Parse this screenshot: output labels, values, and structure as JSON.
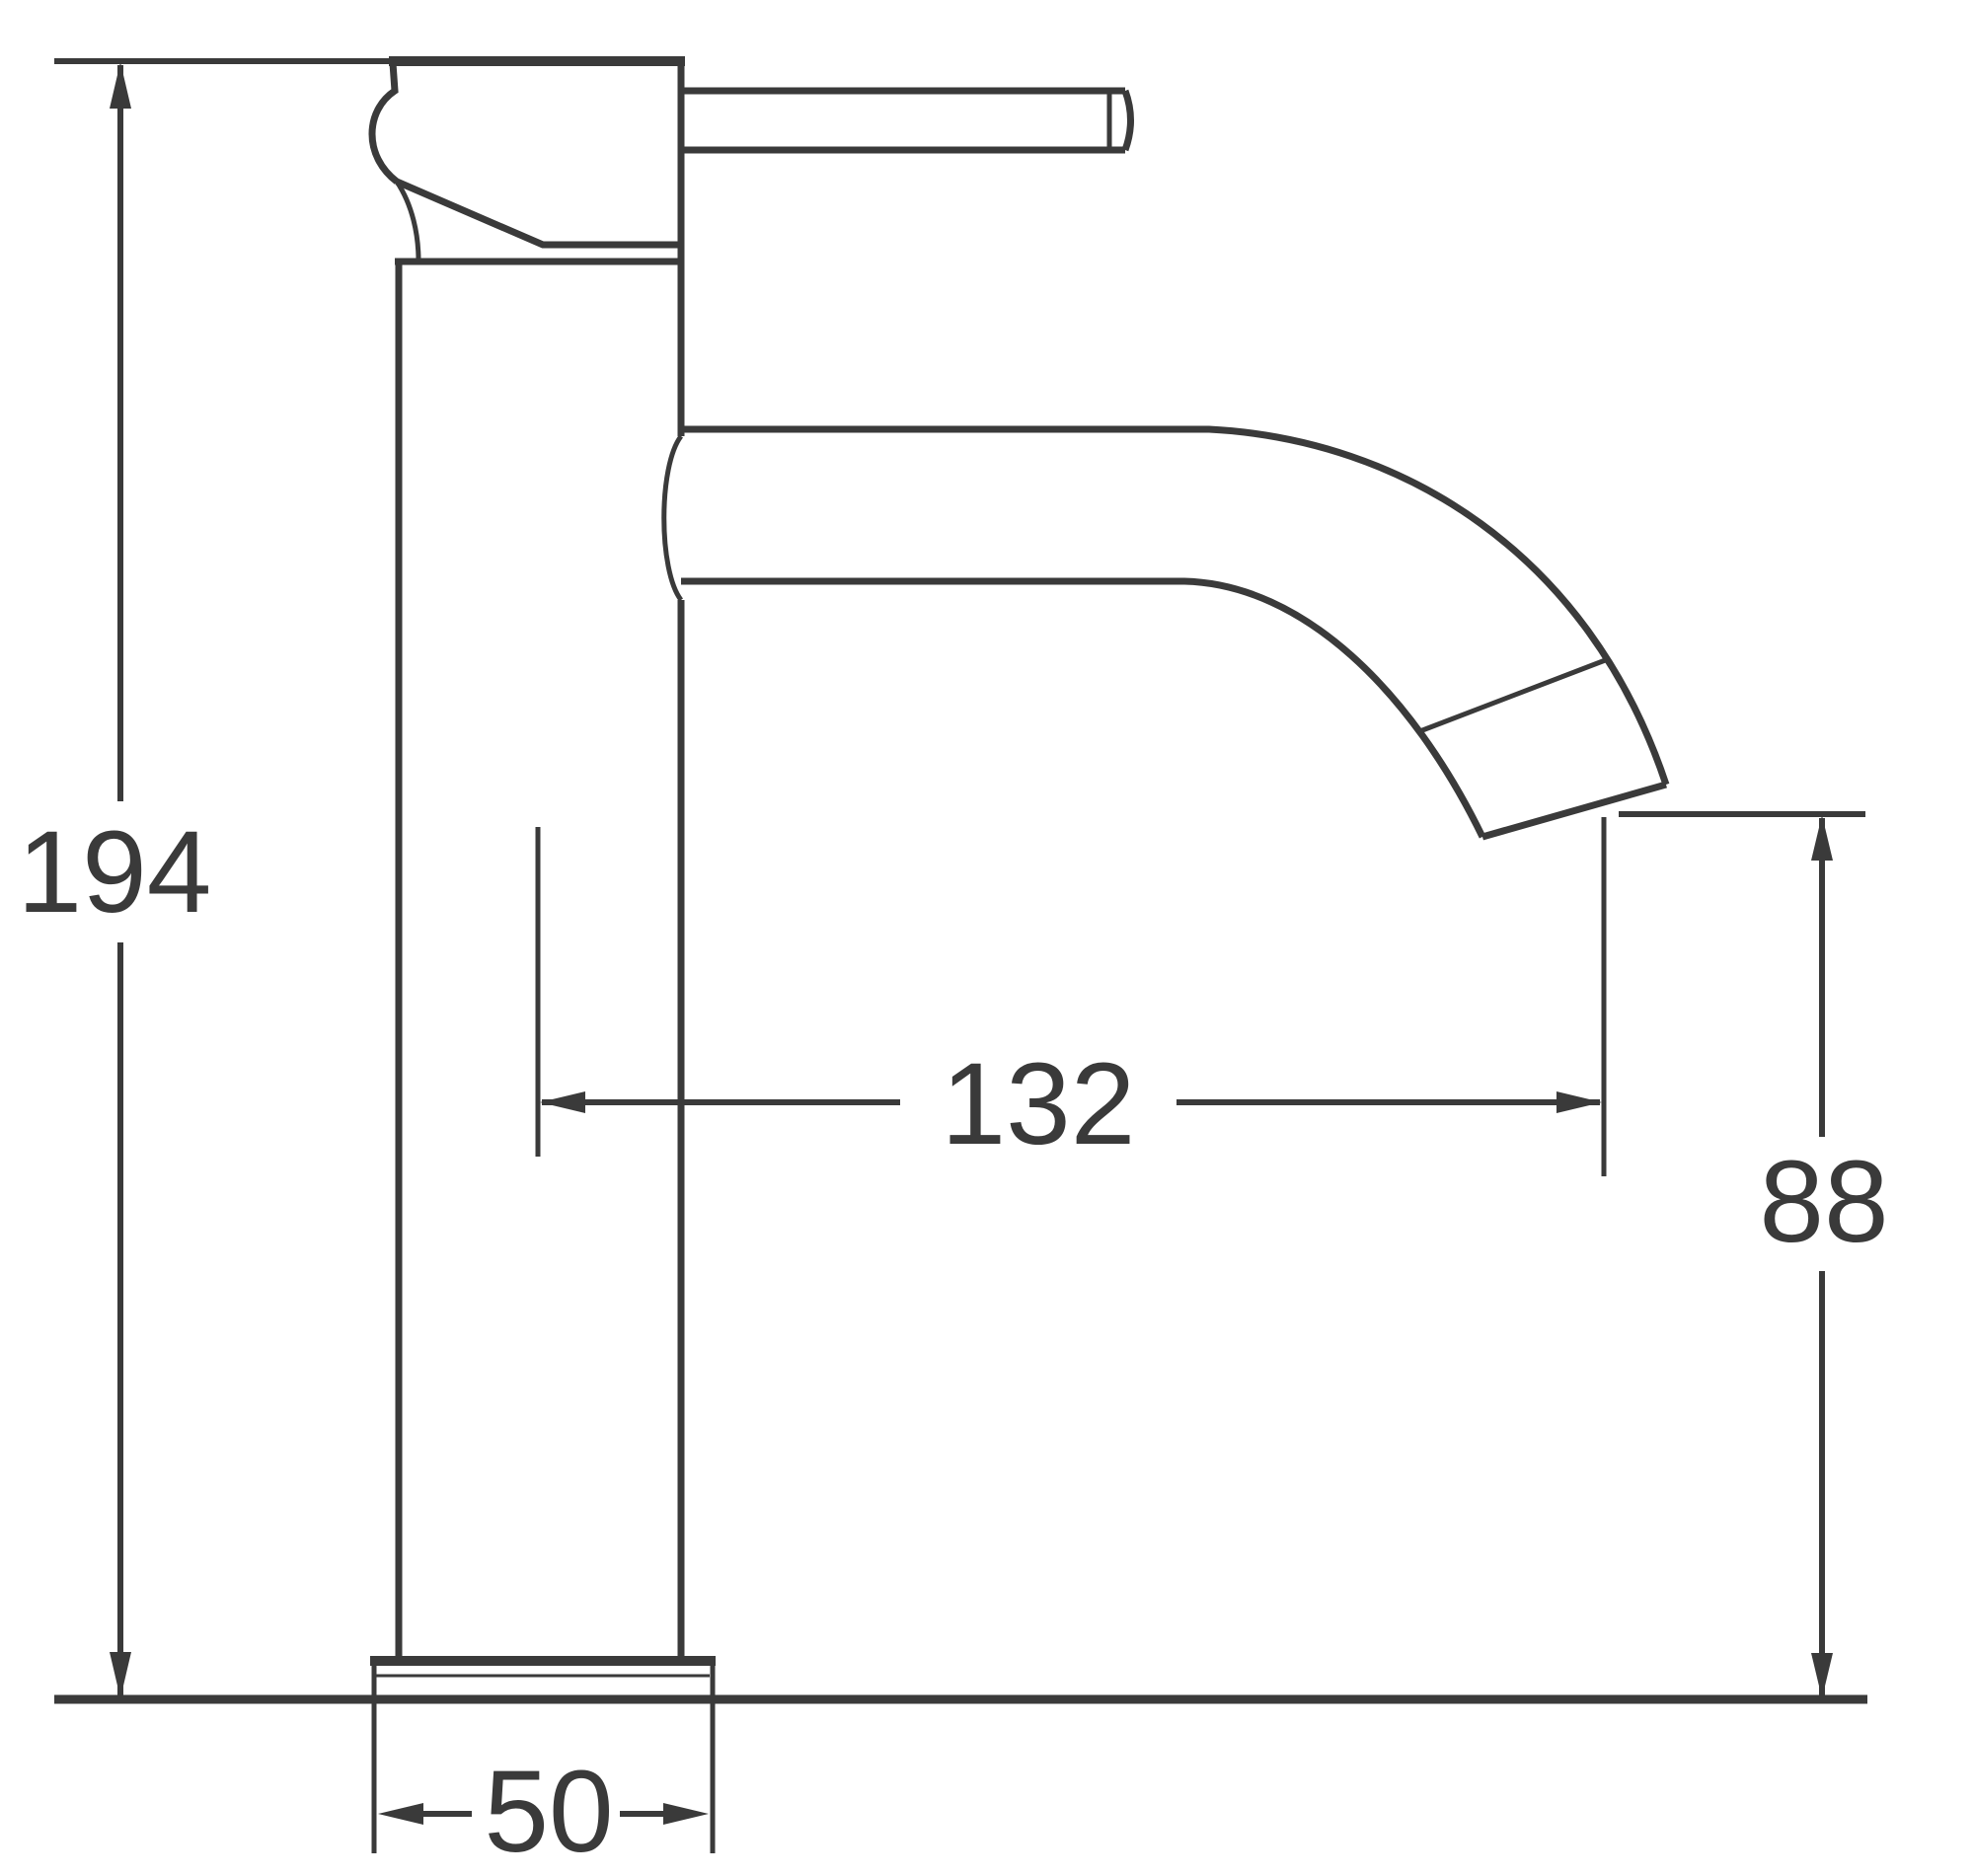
{
  "diagram": {
    "kind": "technical-dimension-drawing",
    "subject": "single-lever tall basin mixer tap, side elevation",
    "line_color": "#3a3a3a",
    "background_color": "#ffffff",
    "dimensions": {
      "overall_height": "194",
      "spout_reach": "132",
      "spout_outlet_height": "88",
      "base_width": "50"
    }
  }
}
